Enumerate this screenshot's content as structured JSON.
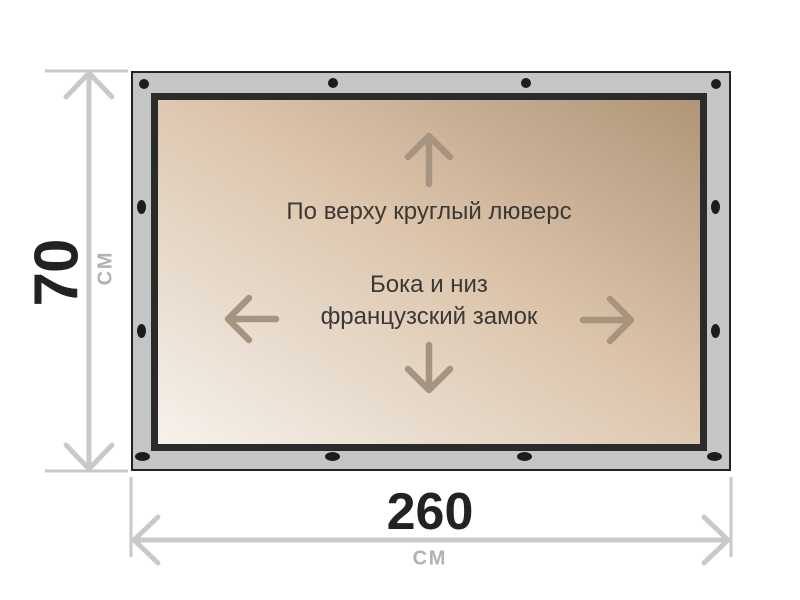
{
  "diagram": {
    "title": "banner-fastening-spec",
    "labels": {
      "top_fastening": "По верху круглый люверс",
      "side_bottom_fastening_line1": "Бока и низ",
      "side_bottom_fastening_line2": "французский замок"
    },
    "colors": {
      "frame": "#c4c6c5",
      "frame_border": "#242424",
      "panel_border": "#2b2b2b",
      "panel_gradient_start": "#f7f2ec",
      "panel_gradient_mid": "#dcc4ab",
      "panel_gradient_end": "#b09578",
      "grommet": "#1c1c1c",
      "arrow": "#a69480",
      "label_text": "#3c3835",
      "dimension_line": "#c9c9c9",
      "dimension_value": "#222222",
      "dimension_unit": "#b2b2b2"
    }
  },
  "dimensions": {
    "height": {
      "value": "70",
      "unit": "СМ"
    },
    "width": {
      "value": "260",
      "unit": "СМ"
    }
  }
}
